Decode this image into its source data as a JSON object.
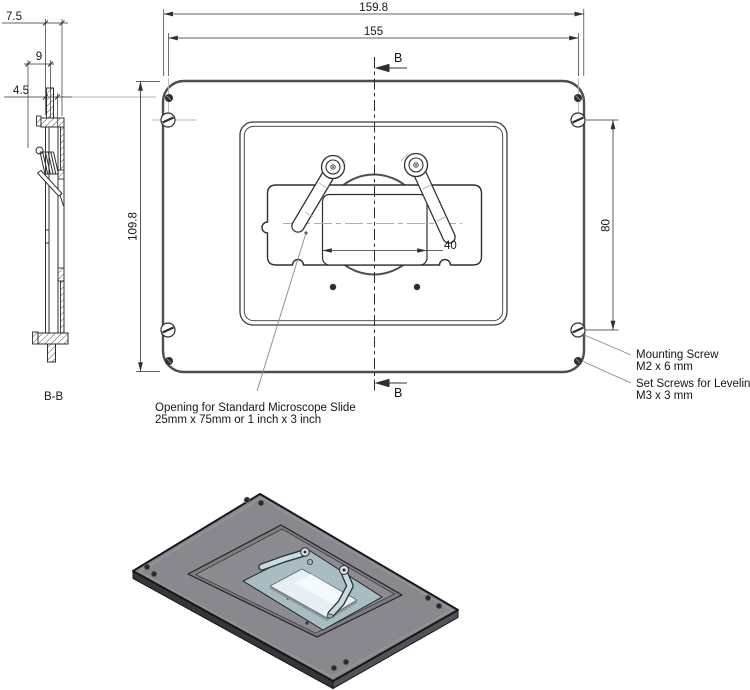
{
  "drawing": {
    "section_view": {
      "label": "B-B"
    },
    "section_cut": {
      "label": "B"
    },
    "dimensions": {
      "outer_width": "159.8",
      "screw_width": "155",
      "outer_height": "109.8",
      "screw_height": "80",
      "window_width": "40",
      "side_depth": "7.5",
      "side_span": "9",
      "side_inner": "4.5"
    },
    "annotations": {
      "opening_note_line1": "Opening for Standard Microscope Slide",
      "opening_note_line2": "25mm x 75mm or 1 inch x 3 inch",
      "mounting_screw_line1": "Mounting Screw",
      "mounting_screw_line2": "M2 x 6 mm",
      "set_screw_line1": "Set Screws for Leveling",
      "set_screw_line2": "M3 x 3 mm"
    },
    "colors": {
      "outline_gray": "#4d4d52",
      "line": "#2f2f33",
      "construction": "#b5b5b5",
      "iso_top": "#88888e",
      "iso_side_left": "#35353a",
      "iso_side_right": "#515157",
      "iso_recess": "#7c7c82",
      "iso_recess_floor": "#8b8b91",
      "iso_pocket": "#a9bcc2",
      "iso_glass": "#e6eff3",
      "iso_clamp": "#c9dae1"
    }
  }
}
